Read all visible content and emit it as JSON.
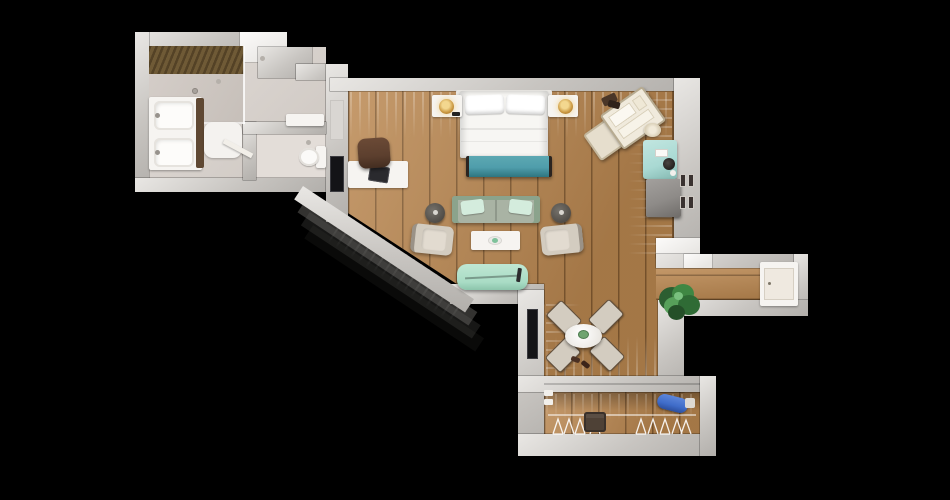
{
  "meta": {
    "description": "Top-down 3D rendered floor plan of a studio hotel suite on a black background",
    "view": "top-down 3D render",
    "canvas": {
      "width": 950,
      "height": 500
    }
  },
  "palette": {
    "bg": "#000000",
    "wallA": "#e9e7e4",
    "wallB": "#c8c5c1",
    "wallC": "#b2afab",
    "wood": "#ba8750",
    "woodLine": "#6e4a24",
    "tile": "#d6d0cb",
    "tileLight": "#e2dcd7",
    "tileDark": "#cdc6c0",
    "slatA": "#544226",
    "slatB": "#6f5a36",
    "white": "#f6f4f1",
    "teal": "#4f9dab",
    "tealDark": "#2e7580",
    "sage": "#a9b3a4",
    "sageDark": "#8ba38c",
    "mint": "#d4ecdd",
    "chaise": "#a9dcc5",
    "fridge": "#a9d9d3",
    "cabinet": "#8e8b88",
    "beige": "#d3ccc0",
    "beigeDark": "#9a9287",
    "brown": "#5c3f2e",
    "gold": "#c9963f",
    "goldDark": "#8a5f1f",
    "tv": "#141417",
    "plantA": "#2c5e31",
    "plantB": "#3f8743",
    "plantC": "#57a05a",
    "blue": "#3f6cc9",
    "blueDark": "#2c4f9e",
    "basket": "#4e4136",
    "door": "#efe9e0"
  },
  "rooms": [
    {
      "id": "bathroom",
      "name": "Bathroom",
      "features": [
        "walk-in shower with slatted ceiling",
        "double vanity",
        "bath mat",
        "toilet room",
        "wall shelf"
      ]
    },
    {
      "id": "bedroom-living",
      "name": "Bedroom / Living Area",
      "features": [
        "double bed",
        "two nightstands with lamps",
        "teal bench",
        "desk with chair",
        "wall TV",
        "sofa with pillows",
        "two armchairs",
        "coffee table",
        "two side tables",
        "chaise",
        "open luggage",
        "mini fridge",
        "cabinet",
        "wall frames"
      ]
    },
    {
      "id": "dining",
      "name": "Dining Nook",
      "features": [
        "round table",
        "four chairs",
        "slippers",
        "wall TV"
      ]
    },
    {
      "id": "hallway",
      "name": "Entry Hallway",
      "features": [
        "entry door",
        "potted plant"
      ]
    },
    {
      "id": "closet",
      "name": "Closet",
      "features": [
        "hangers",
        "laundry basket",
        "ironing board"
      ]
    }
  ],
  "furniture": {
    "shower": "Walk-in shower",
    "vanity": "Double vanity",
    "bath_mat": "Bath mat",
    "toilet": "Toilet",
    "shelf": "Wall shelf",
    "bed": "Double bed",
    "nightstand": "Nightstand",
    "lamp": "Table lamp",
    "bench": "Bench",
    "desk": "Desk",
    "desk_chair": "Desk chair",
    "laptop": "Laptop",
    "tv": "Wall TV",
    "sofa": "Sofa",
    "armchair": "Armchair",
    "coffee_table": "Coffee table",
    "side_table": "Side table",
    "chaise": "Chaise",
    "luggage": "Open luggage",
    "hat": "Hat",
    "fridge": "Mini fridge",
    "cabinet": "Cabinet",
    "frames": "Wall frames",
    "dining_table": "Dining table",
    "dining_chair": "Dining chair",
    "slippers": "Slippers",
    "plant": "Potted plant",
    "entry_door": "Entry door",
    "hangers": "Hangers",
    "basket": "Laundry basket",
    "ironing_board": "Ironing board"
  }
}
